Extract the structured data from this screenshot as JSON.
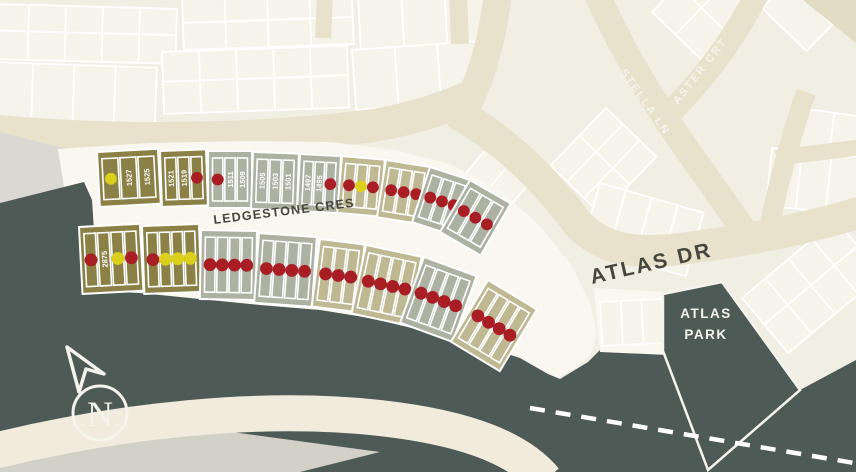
{
  "map": {
    "street_labels": {
      "ledgestone": "LEDGESTONE CRES",
      "atlas": "ATLAS DR",
      "stella": "STELLA LN",
      "aster": "ASTER CRT"
    },
    "park_label": {
      "line1": "ATLAS",
      "line2": "PARK"
    },
    "compass_letter": "N",
    "colors": {
      "olive": "#8b8147",
      "sage": "#adb1a1",
      "tan": "#bfb993",
      "red_dot": "#a81e24",
      "yellow_dot": "#dbcf1d",
      "slate": "#4e5a56"
    },
    "lot_numbers_visible": [
      "1527",
      "1525",
      "1521",
      "1519",
      "1511",
      "1509",
      "1505",
      "1503",
      "1501",
      "1497",
      "1495",
      "2875"
    ],
    "blocks": [
      {
        "row": "north",
        "fill": "olive",
        "x": 97,
        "y": 152,
        "w": 61,
        "h": 55,
        "rot": -3,
        "lots": [
          {
            "dot": "yellow"
          },
          {
            "label": "1527"
          },
          {
            "label": "1525"
          }
        ]
      },
      {
        "row": "north",
        "fill": "olive",
        "x": 160,
        "y": 151,
        "w": 46,
        "h": 56,
        "rot": -2,
        "lots": [
          {
            "label": "1521"
          },
          {
            "label": "1519"
          },
          {
            "dot": "red"
          }
        ]
      },
      {
        "row": "north",
        "fill": "sage",
        "x": 208,
        "y": 151,
        "w": 44,
        "h": 57,
        "rot": 0,
        "lots": [
          {
            "dot": "red"
          },
          {
            "label": "1511"
          },
          {
            "label": "1509"
          }
        ]
      },
      {
        "row": "north",
        "fill": "sage",
        "x": 253,
        "y": 152,
        "w": 46,
        "h": 57,
        "rot": 2,
        "lots": [
          {
            "label": "1505"
          },
          {
            "label": "1503"
          },
          {
            "label": "1501"
          }
        ]
      },
      {
        "row": "north",
        "fill": "sage",
        "x": 300,
        "y": 154,
        "w": 41,
        "h": 57,
        "rot": 3,
        "lots": [
          {
            "label": "1497"
          },
          {
            "label": "1495"
          },
          {
            "dot": "red"
          }
        ]
      },
      {
        "row": "north",
        "fill": "tan",
        "x": 342,
        "y": 156,
        "w": 43,
        "h": 57,
        "rot": 5,
        "lots": [
          {
            "dot": "red"
          },
          {
            "dot": "yellow"
          },
          {
            "dot": "red"
          }
        ]
      },
      {
        "row": "north",
        "fill": "tan",
        "x": 386,
        "y": 160,
        "w": 45,
        "h": 58,
        "rot": 9,
        "lots": [
          {
            "dot": "red"
          },
          {
            "dot": "red"
          },
          {
            "dot": "red"
          }
        ]
      },
      {
        "row": "north",
        "fill": "sage",
        "x": 430,
        "y": 167,
        "w": 44,
        "h": 58,
        "rot": 18,
        "lots": [
          {
            "dot": "red"
          },
          {
            "dot": "red"
          },
          {
            "dot": "red"
          }
        ]
      },
      {
        "row": "north",
        "fill": "sage",
        "x": 470,
        "y": 180,
        "w": 47,
        "h": 60,
        "rot": 30,
        "lots": [
          {
            "dot": "red"
          },
          {
            "dot": "red"
          },
          {
            "dot": "red"
          }
        ]
      },
      {
        "row": "south",
        "fill": "olive",
        "x": 79,
        "y": 227,
        "w": 61,
        "h": 67,
        "rot": -3,
        "lots": [
          {
            "dot": "red"
          },
          {
            "label": "2875"
          },
          {
            "dot": "yellow"
          },
          {
            "dot": "red"
          }
        ]
      },
      {
        "row": "south",
        "fill": "olive",
        "x": 142,
        "y": 226,
        "w": 57,
        "h": 68,
        "rot": -2,
        "lots": [
          {
            "dot": "red"
          },
          {
            "dot": "yellow"
          },
          {
            "dot": "yellow"
          },
          {
            "dot": "yellow"
          }
        ]
      },
      {
        "row": "south",
        "fill": "sage",
        "x": 201,
        "y": 230,
        "w": 56,
        "h": 69,
        "rot": 1,
        "lots": [
          {
            "dot": "red"
          },
          {
            "dot": "red"
          },
          {
            "dot": "red"
          },
          {
            "dot": "red"
          }
        ]
      },
      {
        "row": "south",
        "fill": "sage",
        "x": 259,
        "y": 233,
        "w": 58,
        "h": 70,
        "rot": 4,
        "lots": [
          {
            "dot": "red"
          },
          {
            "dot": "red"
          },
          {
            "dot": "red"
          },
          {
            "dot": "red"
          }
        ]
      },
      {
        "row": "south",
        "fill": "tan",
        "x": 320,
        "y": 239,
        "w": 45,
        "h": 68,
        "rot": 7,
        "lots": [
          {
            "dot": "red"
          },
          {
            "dot": "red"
          },
          {
            "dot": "red"
          }
        ]
      },
      {
        "row": "south",
        "fill": "tan",
        "x": 366,
        "y": 245,
        "w": 57,
        "h": 70,
        "rot": 12,
        "lots": [
          {
            "dot": "red"
          },
          {
            "dot": "red"
          },
          {
            "dot": "red"
          },
          {
            "dot": "red"
          }
        ]
      },
      {
        "row": "south",
        "fill": "sage",
        "x": 424,
        "y": 257,
        "w": 56,
        "h": 70,
        "rot": 20,
        "lots": [
          {
            "dot": "red"
          },
          {
            "dot": "red"
          },
          {
            "dot": "red"
          },
          {
            "dot": "red"
          }
        ]
      },
      {
        "row": "south",
        "fill": "tan",
        "x": 488,
        "y": 280,
        "w": 57,
        "h": 72,
        "rot": 31,
        "lots": [
          {
            "dot": "red"
          },
          {
            "dot": "red"
          },
          {
            "dot": "red"
          },
          {
            "dot": "red"
          }
        ]
      }
    ]
  }
}
